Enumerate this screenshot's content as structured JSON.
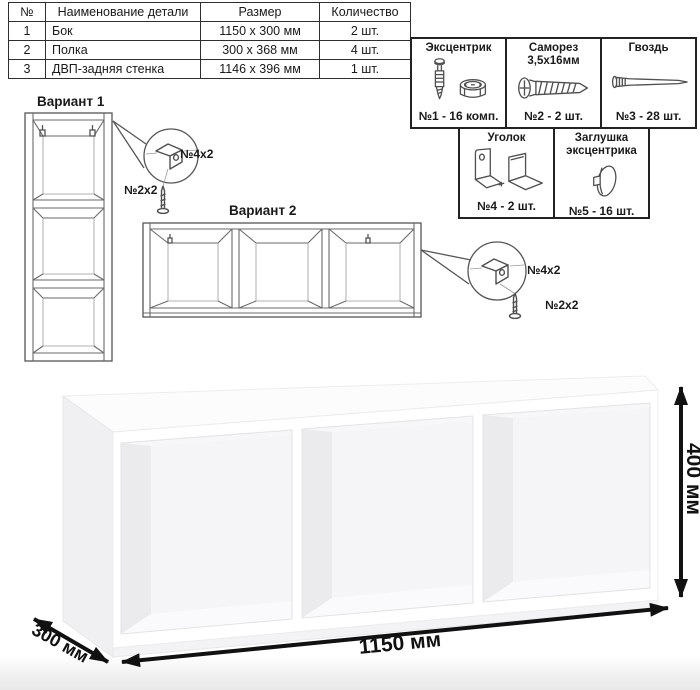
{
  "table": {
    "headers": [
      "№",
      "Наименование детали",
      "Размер",
      "Количество"
    ],
    "rows": [
      [
        "1",
        "Бок",
        "1150 x 300 мм",
        "2 шт."
      ],
      [
        "2",
        "Полка",
        "300 x 368 мм",
        "4 шт."
      ],
      [
        "3",
        "ДВП-задняя стенка",
        "1146 x 396 мм",
        "1 шт."
      ]
    ]
  },
  "hardware": {
    "items": [
      {
        "name": "Эксцентрик",
        "name2": "",
        "count": "№1 - 16 комп."
      },
      {
        "name": "Саморез",
        "name2": "3,5х16мм",
        "count": "№2 - 2 шт."
      },
      {
        "name": "Гвоздь",
        "name2": "",
        "count": "№3 - 28 шт."
      },
      {
        "name": "Уголок",
        "name2": "",
        "count": "№4 - 2 шт."
      },
      {
        "name": "Заглушка",
        "name2": "эксцентрика",
        "count": "№5 - 16 шт."
      }
    ]
  },
  "variant1": {
    "label": "Вариант 1",
    "bracket_qty": "№4х2",
    "screw_qty": "№2х2"
  },
  "variant2": {
    "label": "Вариант 2",
    "bracket_qty": "№4х2",
    "screw_qty": "№2х2"
  },
  "dimensions": {
    "width": "1150 мм",
    "height": "400 мм",
    "depth": "300 мм"
  },
  "colors": {
    "line_art": "#6a6a6a",
    "dimension": "#111111",
    "border": "#222222"
  }
}
